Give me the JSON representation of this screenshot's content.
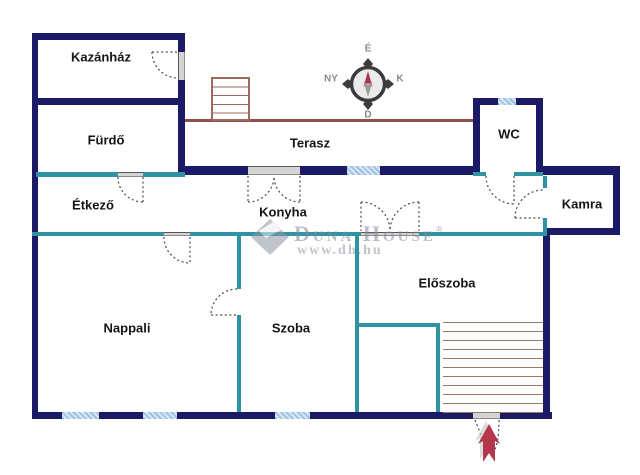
{
  "plan_title": "floor-plan",
  "rooms": [
    {
      "id": "kazanhaz",
      "label": "Kazánház"
    },
    {
      "id": "furdo",
      "label": "Fürdő"
    },
    {
      "id": "terasz",
      "label": "Terasz"
    },
    {
      "id": "wc",
      "label": "WC"
    },
    {
      "id": "etkezo",
      "label": "Étkező"
    },
    {
      "id": "konyha",
      "label": "Konyha"
    },
    {
      "id": "kamra",
      "label": "Kamra"
    },
    {
      "id": "eloszoba",
      "label": "Előszoba"
    },
    {
      "id": "nappali",
      "label": "Nappali"
    },
    {
      "id": "szoba",
      "label": "Szoba"
    }
  ],
  "compass": {
    "north": "É",
    "south": "D",
    "west": "NY",
    "east": "K"
  },
  "watermark": {
    "brand": "Duna House",
    "reg": "®",
    "url": "www.dh.hu"
  },
  "icons": [
    "compass-rose-icon",
    "entrance-arrow-icon",
    "watermark-diamond-icon"
  ],
  "colors": {
    "exterior_wall": "#1a1a66",
    "interior_wall": "#2f93a3",
    "window": "#9fc3e2",
    "terrace_edge": "#8d4f48",
    "stairs": "#a07862",
    "entrance_arrow": "#b5374e",
    "watermark": "#808a96"
  }
}
